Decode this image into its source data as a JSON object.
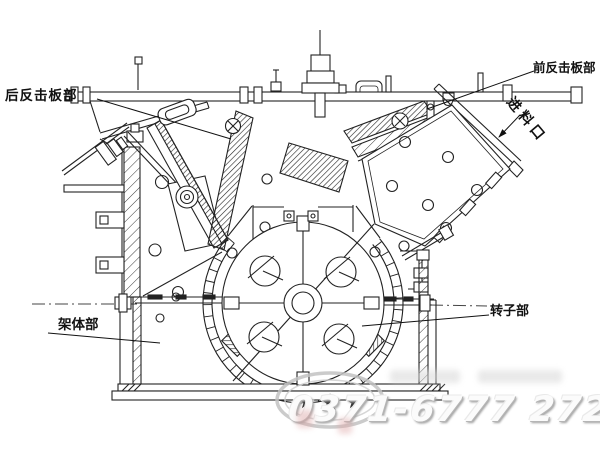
{
  "labels": {
    "rear_impact_plate": "后反击板部",
    "front_impact_plate": "前反击板部",
    "feed_inlet": "进料口",
    "frame_body": "架体部",
    "rotor": "转子部"
  },
  "watermark": {
    "phone": "0371-6777 2727",
    "star": "★"
  },
  "colors": {
    "line": "#1f1f1f",
    "paper": "#ffffff",
    "watermark_gray": "#c8c8c8"
  }
}
